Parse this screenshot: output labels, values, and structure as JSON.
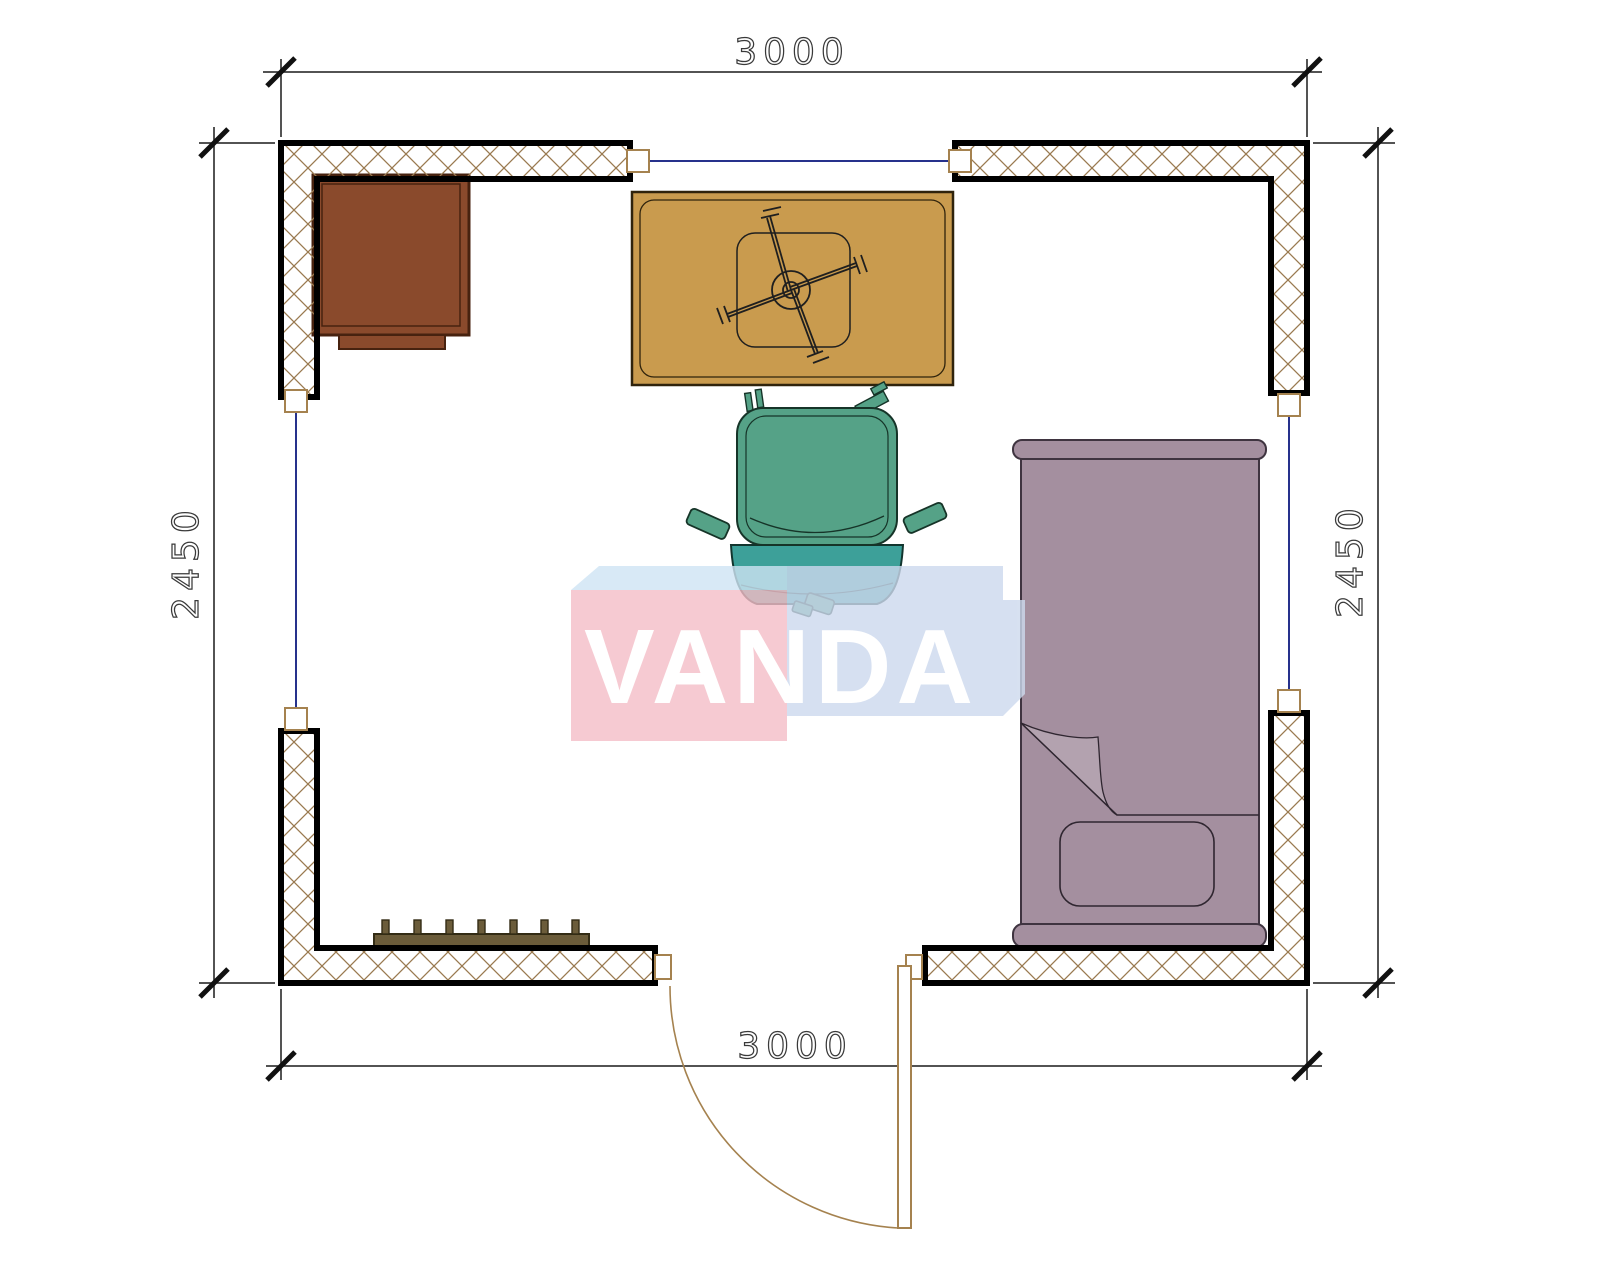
{
  "title": "Room floor plan 3000 x 2450 with furniture",
  "dimensions": {
    "top": "3000",
    "bottom": "3000",
    "left": "2450",
    "right": "2450"
  },
  "watermark": {
    "text": "VANDA"
  },
  "furniture": [
    {
      "label": "desk-cabinet"
    },
    {
      "label": "table-with-pedestal-base"
    },
    {
      "label": "office-chair"
    },
    {
      "label": "single-bed"
    },
    {
      "label": "radiator"
    },
    {
      "label": "door-with-swing"
    },
    {
      "label": "window-top"
    },
    {
      "label": "window-left"
    },
    {
      "label": "window-right"
    }
  ],
  "colors": {
    "wall_hatch": "#9a7a50",
    "wall_border": "#000000",
    "window_line": "#26318c",
    "frame": "#a5824f",
    "dim_line": "#1a1a1a",
    "dim_text": "#3a3a3a",
    "desk": "#8a4a2c",
    "desk_border": "#47220f",
    "table": "#c99b4e",
    "table_border": "#2f230c",
    "chair_seat": "#55a287",
    "chair_front": "#3da099",
    "chair_outline": "#163428",
    "bed": "#a48f9f",
    "bed_fold": "#b3a2af",
    "bed_outline": "#3f3440",
    "radiator": "#6b5c3a",
    "radiator_border": "#332c15",
    "watermark_pink": "#f5bdc7",
    "watermark_blue": "#cdd9ee",
    "watermark_top": "#cfe4f4",
    "watermark_text": "#ffffff"
  }
}
